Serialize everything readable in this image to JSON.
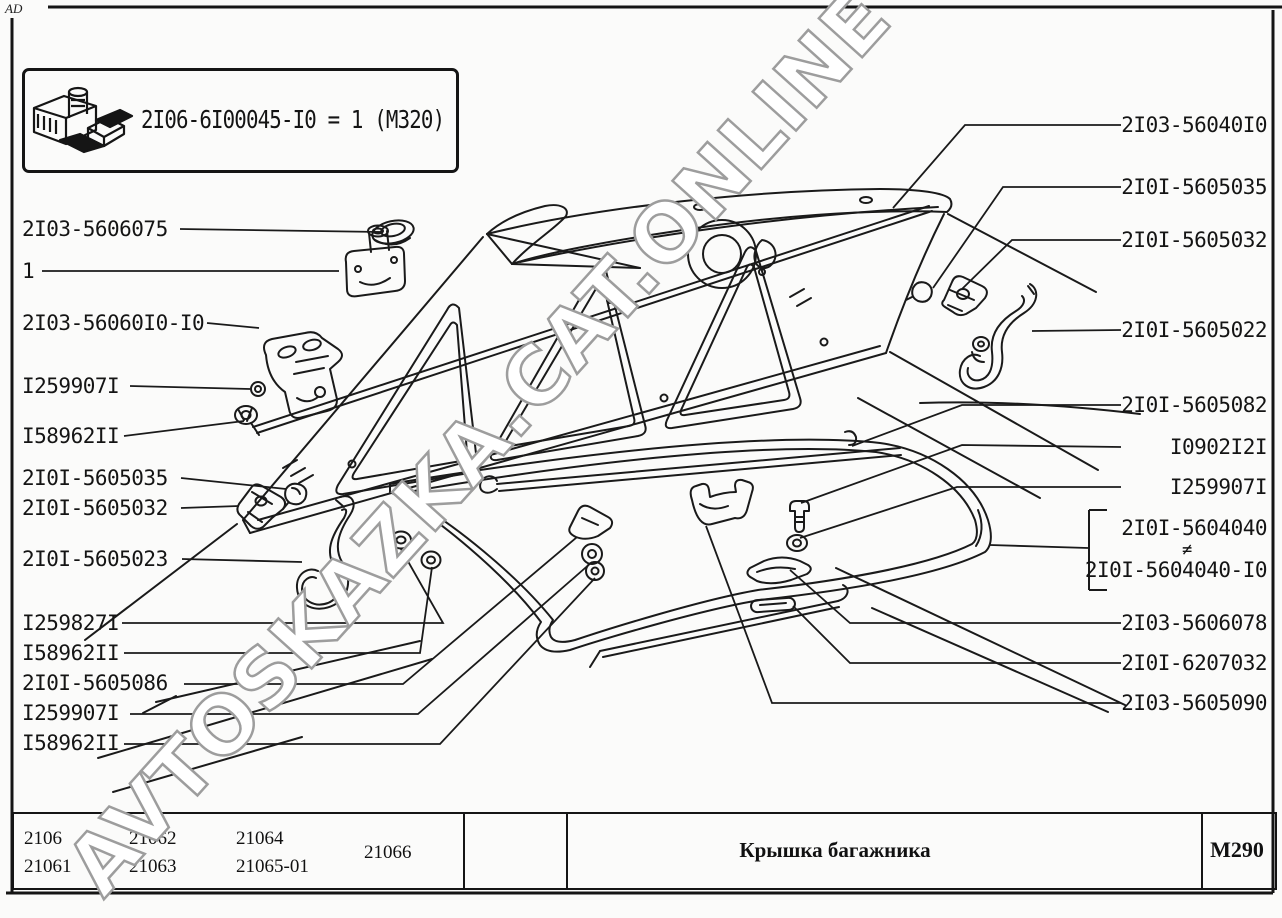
{
  "corner_mark": "AD",
  "info_box": {
    "text": "2I06-6I00045-I0 = 1 (М320)",
    "icon": "parts-kit-icon"
  },
  "watermark": {
    "text": "AVTOSKAZKA.CAT.ONLINE",
    "color": "#9d9d9d"
  },
  "left_labels": [
    "2I03-5606075",
    "1",
    "2I03-56060I0-I0",
    "I259907I",
    "I58962II",
    "2I0I-5605035",
    "2I0I-5605032",
    "2I0I-5605023",
    "I259827I",
    "I58962II",
    "2I0I-5605086",
    "I259907I",
    "I58962II"
  ],
  "right_labels": [
    "2I03-56040I0",
    "2I0I-5605035",
    "2I0I-5605032",
    "2I0I-5605022",
    "2I0I-5605082",
    "I0902I2I",
    "I259907I",
    "2I03-5606078",
    "2I0I-6207032",
    "2I03-5605090"
  ],
  "variant_group": {
    "top": "2I0I-5604040",
    "separator": "≠",
    "bottom": "2I0I-5604040-I0"
  },
  "footer": {
    "models_col1": [
      "2106",
      "21061"
    ],
    "models_col2": [
      "21062",
      "21063"
    ],
    "models_col3": [
      "21064",
      "21065-01"
    ],
    "models_col4": "21066",
    "title": "Крышка багажника",
    "sheet_code": "М290"
  },
  "diagram": {
    "alt": "Exploded line drawing of trunk lid with hinges, torsion bars, seal and fasteners"
  }
}
